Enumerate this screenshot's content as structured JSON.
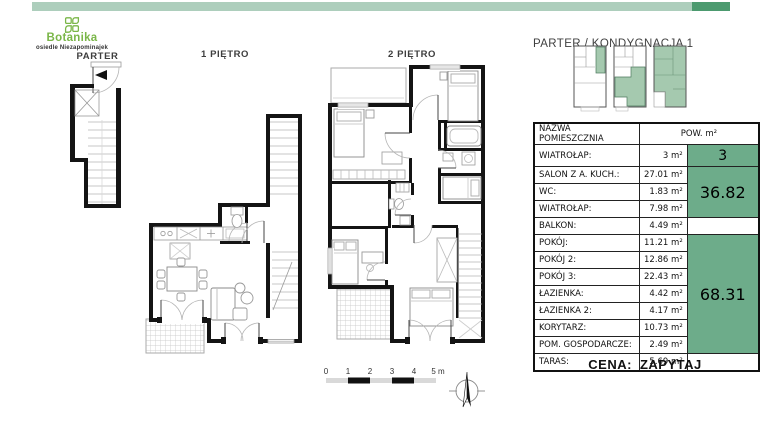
{
  "brand": {
    "name": "Botanika",
    "subtitle": "osiedle Niezapominajek"
  },
  "header": {
    "location_label": "PARTER / KONDYGNACJA 1"
  },
  "floors": {
    "parter": "PARTER",
    "floor1": "1 PIĘTRO",
    "floor2": "2 PIĘTRO"
  },
  "table": {
    "col_name": "NAZWA POMIESZCZNIA",
    "col_area": "POW. m²",
    "rows": [
      {
        "name": "WIATROŁAP:",
        "area": "3 m²"
      },
      {
        "name": "SALON Z A. KUCH.:",
        "area": "27.01 m²"
      },
      {
        "name": "WC:",
        "area": "1.83 m²"
      },
      {
        "name": "WIATROŁAP:",
        "area": "7.98 m²"
      },
      {
        "name": "BALKON:",
        "area": "4.49 m²"
      },
      {
        "name": "POKÓJ:",
        "area": "11.21 m²"
      },
      {
        "name": "POKÓJ 2:",
        "area": "12.86 m²"
      },
      {
        "name": "POKÓJ 3:",
        "area": "22.43 m²"
      },
      {
        "name": "ŁAZIENKA:",
        "area": "4.42 m²"
      },
      {
        "name": "ŁAZIENKA 2:",
        "area": "4.17 m²"
      },
      {
        "name": "KORYTARZ:",
        "area": "10.73 m²"
      },
      {
        "name": "POM. GOSPODARCZE:",
        "area": "2.49 m²"
      },
      {
        "name": "TARAS:",
        "area": "5.69 m²"
      }
    ],
    "totals": {
      "group1": "3",
      "group2": "36.82",
      "group3": "68.31"
    }
  },
  "price": {
    "label": "CENA:",
    "value": "ZAPYTAJ"
  },
  "scalebar": {
    "ticks": [
      "0",
      "1",
      "2",
      "3",
      "4",
      "5 m"
    ]
  },
  "colors": {
    "accent_bar_light": "#adcebc",
    "accent_bar_dark": "#4c9a6f",
    "table_green": "#6dac8a",
    "thumbnail_green": "#a5c9af",
    "logo_green": "#7ab648"
  }
}
